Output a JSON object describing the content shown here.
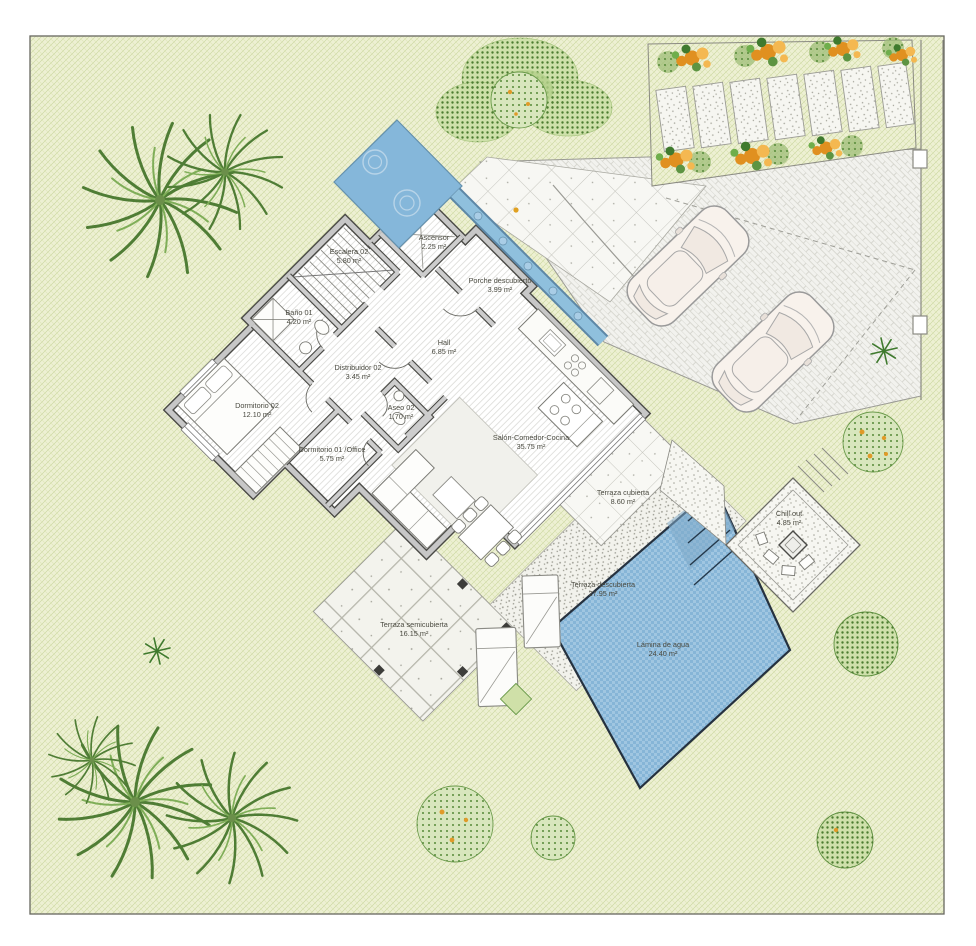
{
  "plan": {
    "rooms": [
      {
        "name": "Escalera 02",
        "area": "5.80 m²"
      },
      {
        "name": "Ascensor",
        "area": "2.25 m²"
      },
      {
        "name": "Porche descubierto",
        "area": "3.99 m²"
      },
      {
        "name": "Baño 01",
        "area": "4.20 m²"
      },
      {
        "name": "Hall",
        "area": "6.85 m²"
      },
      {
        "name": "Distribuidor 02",
        "area": "3.45 m²"
      },
      {
        "name": "Dormitorio 02",
        "area": "12.10 m²"
      },
      {
        "name": "Aseo 02",
        "area": "1.70 m²"
      },
      {
        "name": "Dormitorio 01 /Office",
        "area": "5.75 m²"
      },
      {
        "name": "Salón-Comedor-Cocina",
        "area": "35.75 m²"
      },
      {
        "name": "Terraza cubierta",
        "area": "8.60 m²"
      },
      {
        "name": "Chill out",
        "area": "4.85 m²"
      },
      {
        "name": "Terraza descubierta",
        "area": "27.95 m²"
      },
      {
        "name": "Terraza semicubierta",
        "area": "16.15 m²"
      },
      {
        "name": "Lámina de agua",
        "area": "24.40 m²"
      }
    ],
    "colors": {
      "pool_water": "#9cc4e0",
      "water_feature": "#85b7da",
      "lawn": "#edf0d3",
      "flower_orange": "#e2921d",
      "foliage_green": "#6aa04b",
      "wall_gray": "#c7c7c7",
      "paving_light": "#f4f4ef"
    }
  }
}
